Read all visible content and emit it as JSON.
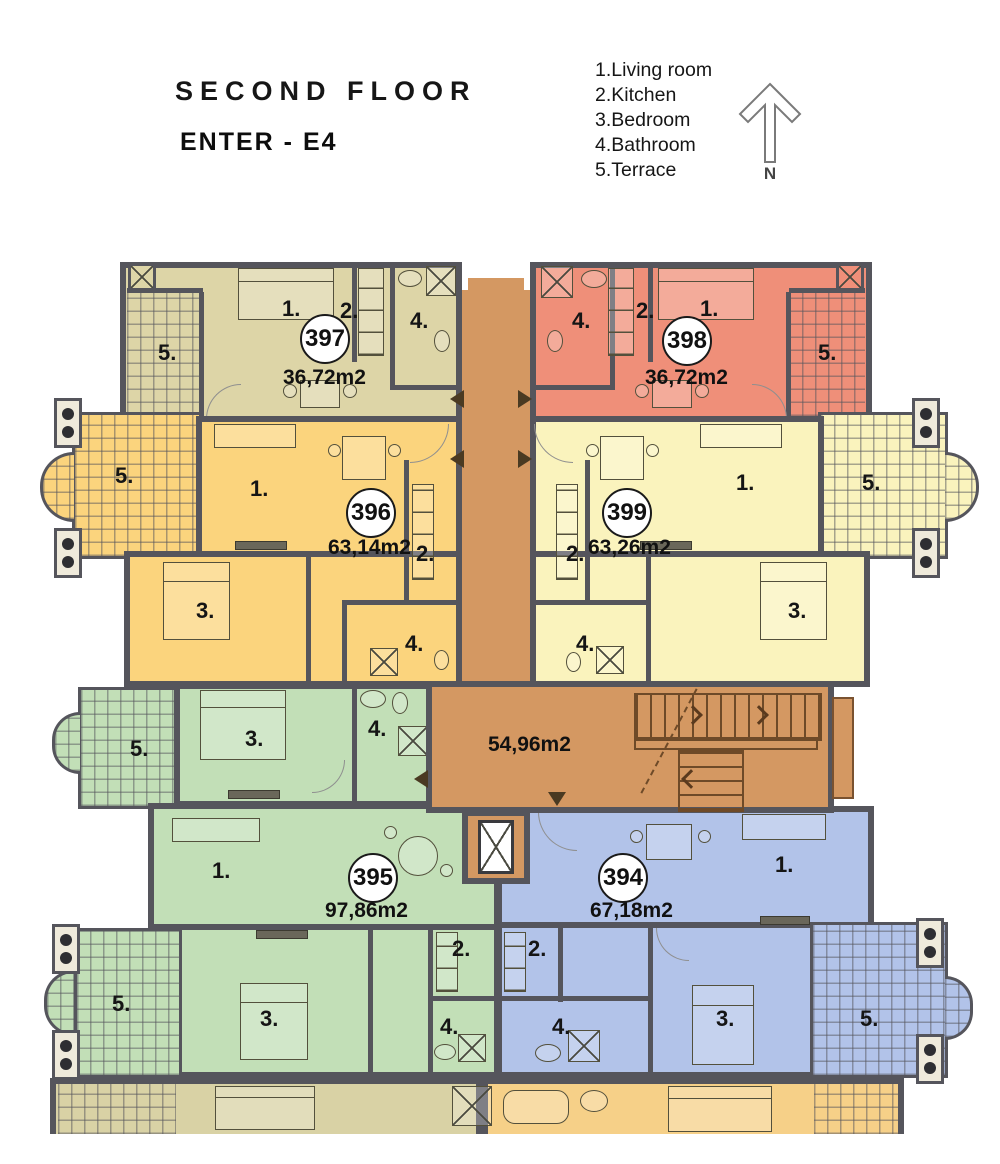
{
  "header": {
    "title": "SECOND FLOOR",
    "enter": "ENTER - E4"
  },
  "legend": {
    "items": [
      "1.Living room",
      "2.Kitchen",
      "3.Bedroom",
      "4.Bathroom",
      "5.Terrace"
    ]
  },
  "compass": {
    "label": "N"
  },
  "rooms": {
    "living": "1.",
    "kitchen": "2.",
    "bedroom": "3.",
    "bathroom": "4.",
    "terrace": "5."
  },
  "apartments": {
    "a397": {
      "number": "397",
      "area": "36,72m2"
    },
    "a398": {
      "number": "398",
      "area": "36,72m2"
    },
    "a396": {
      "number": "396",
      "area": "63,14m2"
    },
    "a399": {
      "number": "399",
      "area": "63,26m2"
    },
    "a395": {
      "number": "395",
      "area": "97,86m2"
    },
    "a394": {
      "number": "394",
      "area": "67,18m2"
    }
  },
  "corridor": {
    "area": "54,96m2"
  },
  "colors": {
    "wall": "#55555c",
    "a397": "#ddd5a7",
    "a398": "#ef8f79",
    "a396": "#fbd47d",
    "a399": "#faf3bd",
    "a395": "#c2dfb7",
    "a394": "#b2c3e9",
    "corridor": "#d49862",
    "lower_tan": "#d9d2a5",
    "lower_yellow": "#f6d088"
  }
}
